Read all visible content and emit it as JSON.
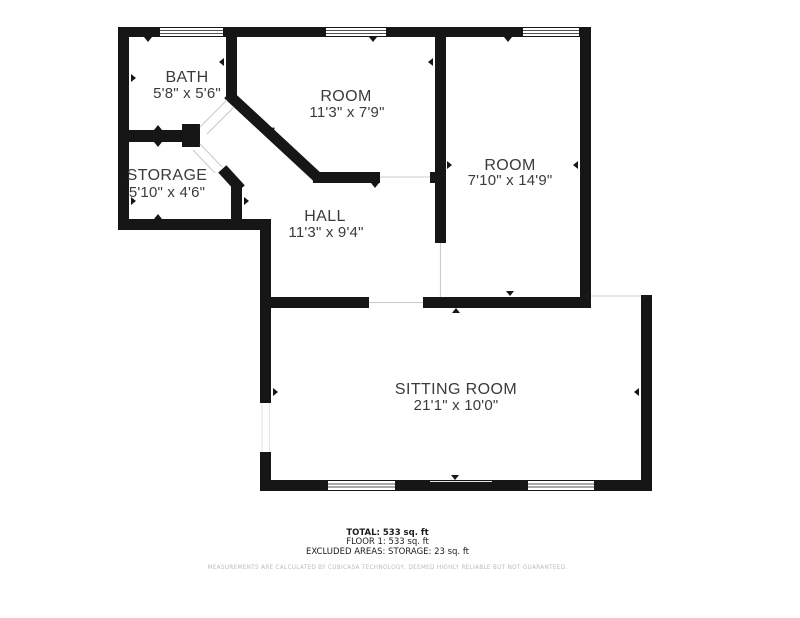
{
  "floor_plan": {
    "rooms": [
      {
        "id": "bath",
        "name": "BATH",
        "dims": "5'8\" x 5'6\""
      },
      {
        "id": "room-middle",
        "name": "ROOM",
        "dims": "11'3\" x 7'9\""
      },
      {
        "id": "room-right",
        "name": "ROOM",
        "dims": "7'10\" x 14'9\""
      },
      {
        "id": "storage",
        "name": "STORAGE",
        "dims": "5'10\" x 4'6\""
      },
      {
        "id": "hall",
        "name": "HALL",
        "dims": "11'3\" x 9'4\""
      },
      {
        "id": "sitting-room",
        "name": "SITTING ROOM",
        "dims": "21'1\" x 10'0\""
      }
    ],
    "colors": {
      "wall": "#161616",
      "label": "#3b3b3b",
      "opening_line": "#d5d5d5"
    }
  },
  "footer": {
    "total": "TOTAL: 533 sq. ft",
    "floor": "FLOOR 1: 533 sq. ft",
    "excluded": "EXCLUDED AREAS: STORAGE: 23 sq. ft",
    "disclaimer": "MEASUREMENTS ARE CALCULATED BY CUBICASA TECHNOLOGY, DEEMED HIGHLY RELIABLE BUT NOT GUARANTEED."
  }
}
